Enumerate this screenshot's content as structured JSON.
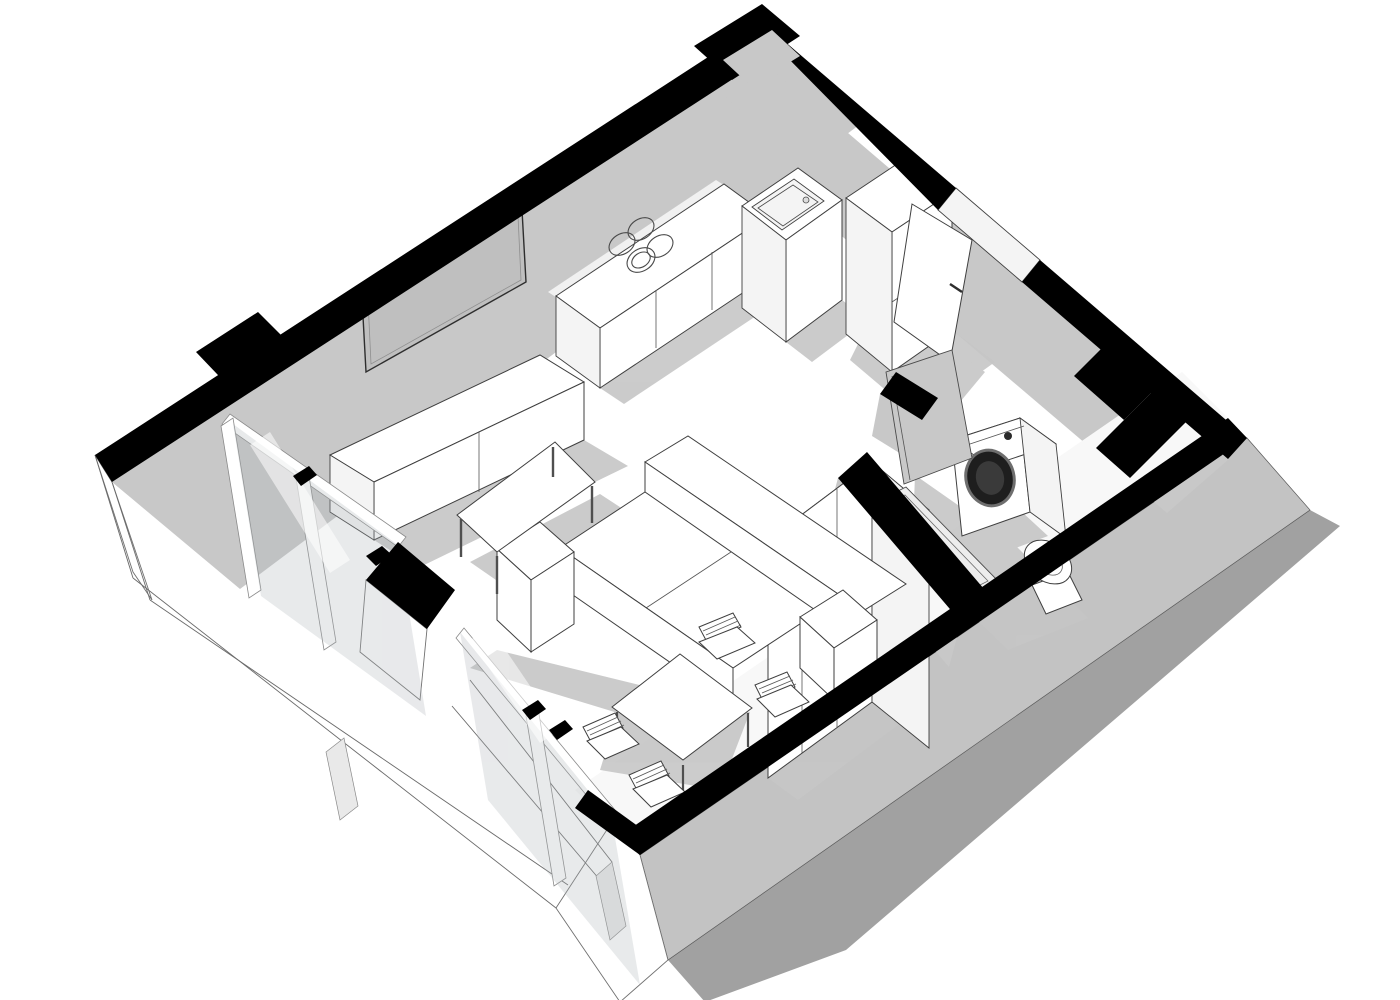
{
  "meta": {
    "description": "Monochrome 3D axonometric cutaway floor plan of a small studio apartment, sketch render style",
    "view": "cutaway-top-iso",
    "text_content": "none"
  },
  "colors": {
    "background": "#ffffff",
    "wall_cut": "#000000",
    "interior_wall": "#c8c8c8",
    "interior_wall_light": "#f7f7f7",
    "exterior_wall": "#c3c3c3",
    "ground_shadow": "#a1a1a1",
    "floor_shadow": "#c6c6c6",
    "glass_tint": "#aeb4b8",
    "furniture": "#ffffff",
    "tv_screen": "#bfbfbf",
    "washer_door": "#1e1e1e",
    "line": "#3f3f3f"
  },
  "scene": {
    "rooms": [
      {
        "name": "living-kitchen",
        "furniture": [
          "kitchen-counter-with-cooktop-4-burners",
          "kitchen-sink-cabinet",
          "tall-cabinet",
          "wall-tv",
          "media-console",
          "coffee-table",
          "three-seat-sofa"
        ]
      },
      {
        "name": "dining-sleeping-area",
        "furniture": [
          "wardrobe-cabinet",
          "dining-table",
          "four-slat-back-chairs"
        ]
      },
      {
        "name": "bathroom",
        "furniture": [
          "washing-machine",
          "toilet",
          "shower-tray"
        ]
      },
      {
        "name": "entry-hall",
        "furniture": [
          "entry-door-open",
          "bathroom-door-open"
        ]
      }
    ],
    "features": [
      "black-section-cut-walls",
      "floor-to-ceiling-glazing-southwest",
      "terrace-slab-outlines-lower-left",
      "cast-drop-shadow-lower-right"
    ]
  }
}
